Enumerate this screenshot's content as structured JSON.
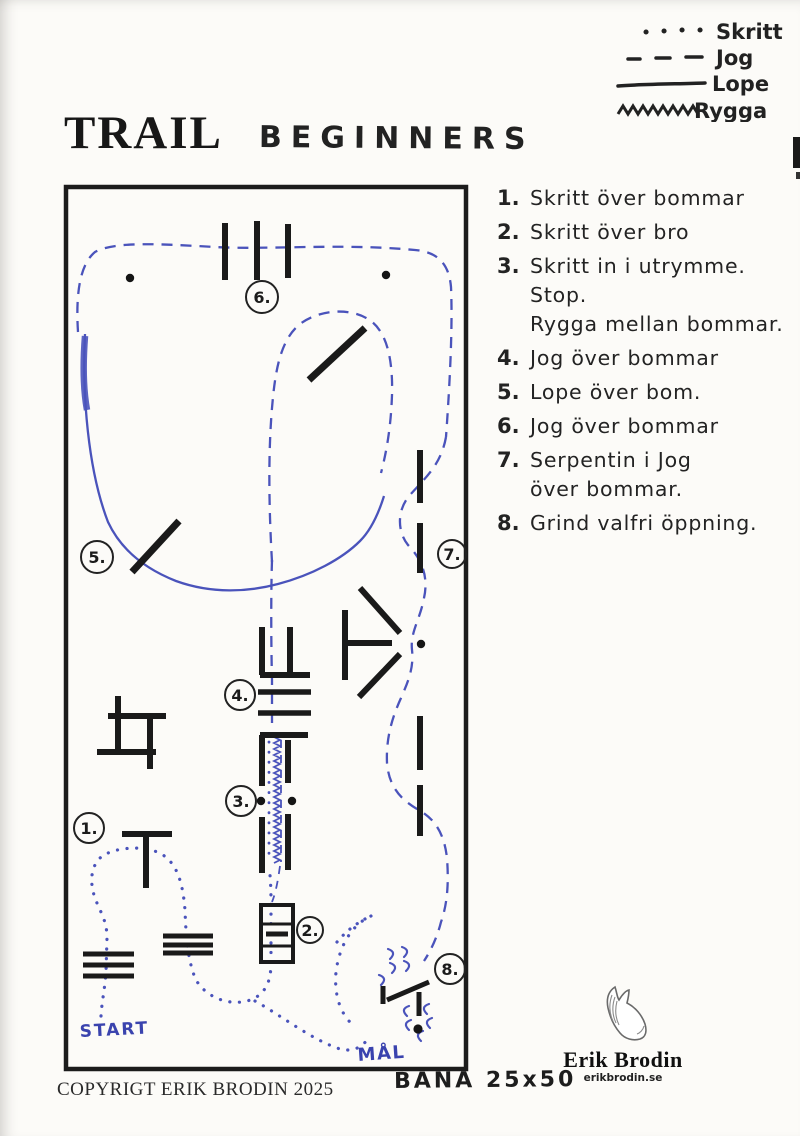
{
  "page": {
    "title": "TRAIL",
    "subtitle": "BEGINNERS",
    "copyright": "COPYRIGT ERIK BRODIN 2025",
    "arena_label": "BANA 25x50"
  },
  "legend": {
    "items": [
      {
        "style": "dotted",
        "label": "Skritt"
      },
      {
        "style": "dashed",
        "label": "Jog"
      },
      {
        "style": "solid",
        "label": "Lope"
      },
      {
        "style": "zigzag",
        "label": "Rygga"
      }
    ]
  },
  "instructions": [
    {
      "num": "1.",
      "lines": [
        "Skritt över bommar"
      ]
    },
    {
      "num": "2.",
      "lines": [
        "Skritt över bro"
      ]
    },
    {
      "num": "3.",
      "lines": [
        "Skritt in i utrymme.",
        "Stop.",
        "Rygga mellan bommar."
      ]
    },
    {
      "num": "4.",
      "lines": [
        "Jog över bommar"
      ]
    },
    {
      "num": "5.",
      "lines": [
        "Lope över bom."
      ]
    },
    {
      "num": "6.",
      "lines": [
        "Jog över bommar"
      ]
    },
    {
      "num": "7.",
      "lines": [
        "Serpentin i Jog",
        "över bommar."
      ]
    },
    {
      "num": "8.",
      "lines": [
        "Grind valfri öppning."
      ]
    }
  ],
  "course": {
    "start_label": "START",
    "goal_label": "MÅL",
    "numbers": {
      "n1": "1.",
      "n2": "2.",
      "n3": "3.",
      "n4": "4.",
      "n5": "5.",
      "n6": "6.",
      "n7": "7.",
      "n8": "8."
    }
  },
  "logo": {
    "name": "Erik Brodin",
    "website": "erikbrodin.se"
  },
  "colors": {
    "ink_blue": "#4a53bb",
    "bar_black": "#1a1a1a"
  }
}
